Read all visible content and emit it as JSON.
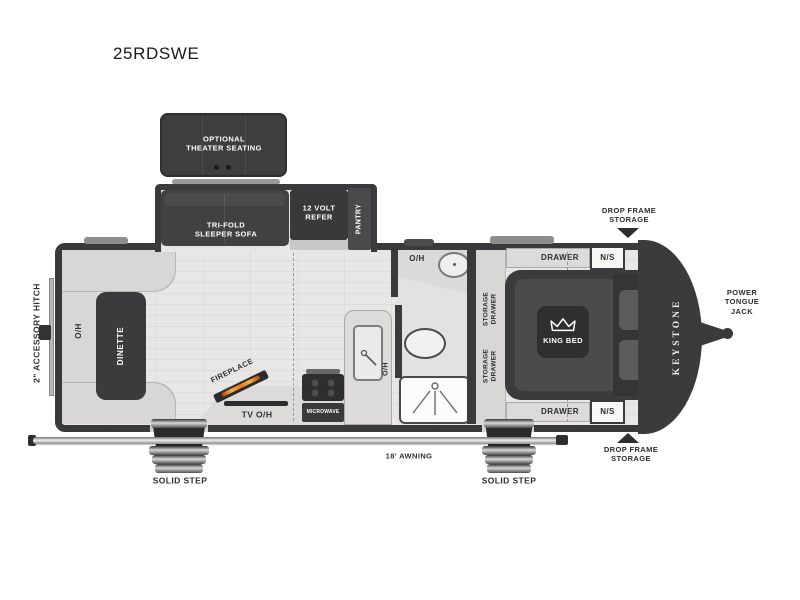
{
  "title": "25RDSWE",
  "exterior": {
    "accessory_hitch": "2\" ACCESSORY HITCH",
    "brand": "KEYSTONE",
    "power_tongue_jack": "POWER\nTONGUE\nJACK",
    "drop_frame_storage_top": "DROP FRAME\nSTORAGE",
    "drop_frame_storage_bottom": "DROP FRAME\nSTORAGE",
    "awning": "18' AWNING",
    "solid_step_left": "SOLID STEP",
    "solid_step_right": "SOLID STEP"
  },
  "slide_out": {
    "theater_seating": "OPTIONAL\nTHEATER SEATING",
    "sleeper_sofa": "TRI-FOLD\nSLEEPER SOFA",
    "refrigerator": "12 VOLT\nREFER",
    "pantry": "PANTRY"
  },
  "living_area": {
    "dinette": "DINETTE",
    "overhead_cabinet": "O/H"
  },
  "kitchen": {
    "fireplace": "FIREPLACE",
    "tv_overhead": "TV O/H",
    "microwave": "MICROWAVE",
    "overhead_cabinet": "O/H",
    "sink_overhead": "O/H"
  },
  "bathroom": {
    "vanity_overhead": "O/H"
  },
  "bedroom": {
    "king_bed": "KING BED",
    "drawer_top": "DRAWER",
    "drawer_bottom": "DRAWER",
    "nightstand_top": "N/S",
    "nightstand_bottom": "N/S",
    "storage_drawer_upper": "STORAGE\nDRAWER",
    "storage_drawer_lower": "STORAGE\nDRAWER"
  },
  "colors": {
    "wall": "#3a393b",
    "furniture_dark": "#3e3d3f",
    "floor": "#e7e6e4",
    "counter": "#dcdbd9",
    "flame": "#e8791e",
    "label": "#2e2d2f"
  }
}
